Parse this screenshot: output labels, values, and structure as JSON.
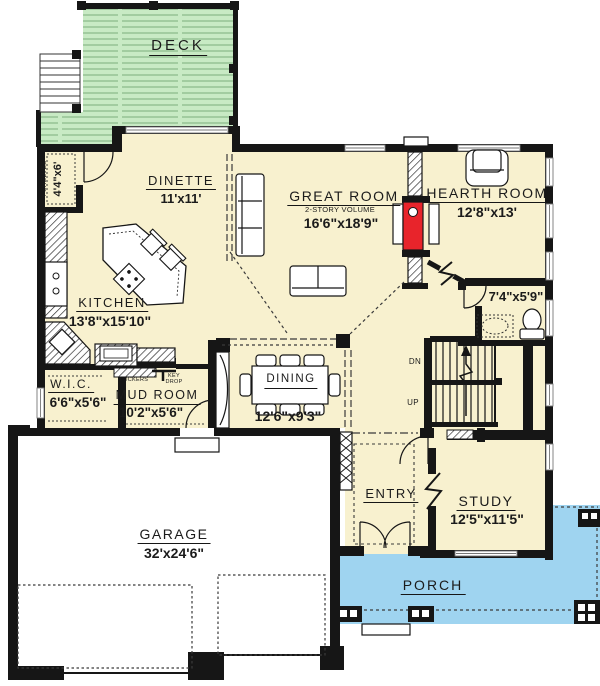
{
  "colors": {
    "floor": "#f8f1cf",
    "deck": "#c8eac4",
    "porch": "#9fd4f0",
    "fireplace": "#e8242b",
    "wall": "#161616",
    "garage_floor": "#ffffff"
  },
  "rooms": {
    "deck": {
      "name": "DECK"
    },
    "dinette": {
      "name": "DINETTE",
      "dims": "11'x11'"
    },
    "great_room": {
      "name": "GREAT ROOM",
      "note": "2-STORY VOLUME",
      "dims": "16'6\"x18'9\""
    },
    "hearth_room": {
      "name": "HEARTH ROOM",
      "dims": "12'8\"x13'"
    },
    "kitchen": {
      "name": "KITCHEN",
      "dims": "13'8\"x15'10\""
    },
    "pantry": {
      "name": "4 SHELVES",
      "dims": "4'4\"x6'"
    },
    "wic": {
      "name": "W.I.C.",
      "dims": "6'6\"x5'6\""
    },
    "mud_room": {
      "name": "MUD ROOM",
      "dims": "10'2\"x5'6\""
    },
    "dining": {
      "name": "DINING",
      "dims": "12'6\"x9'3\""
    },
    "bath": {
      "dims": "7'4\"x5'9\""
    },
    "entry": {
      "name": "ENTRY"
    },
    "study": {
      "name": "STUDY",
      "dims": "12'5\"x11'5\""
    },
    "garage": {
      "name": "GARAGE",
      "dims": "32'x24'6\""
    },
    "porch": {
      "name": "PORCH"
    }
  },
  "annotations": {
    "lockers": "LOCKERS",
    "key_drop": "KEY\nDROP",
    "down": "DN",
    "up": "UP"
  }
}
